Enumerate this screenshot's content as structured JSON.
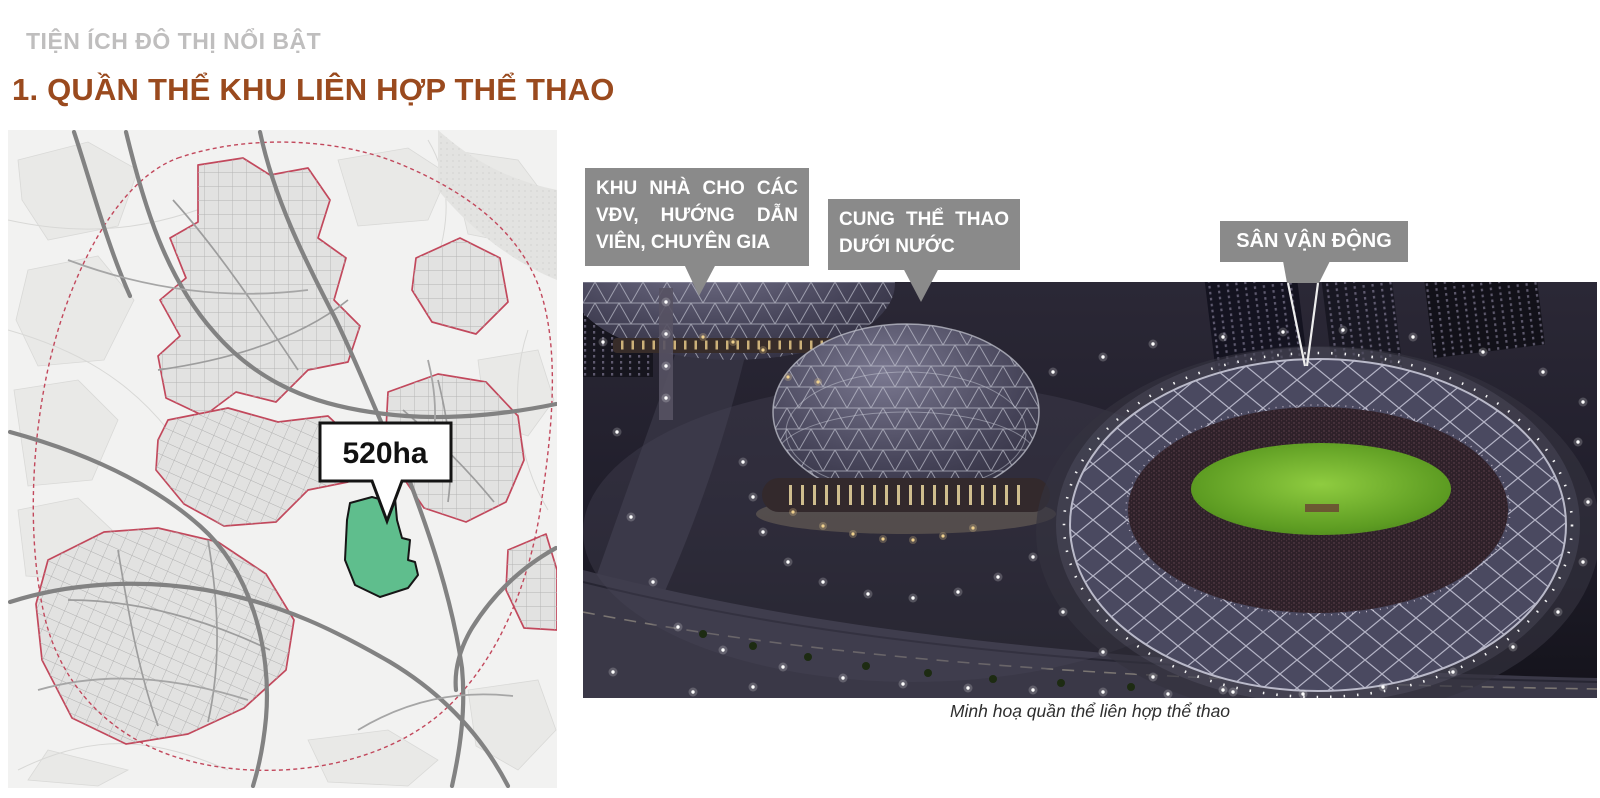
{
  "header": {
    "eyebrow": "TIỆN ÍCH ĐÔ THỊ NỔI BẬT",
    "title": "1. QUẦN THỂ KHU LIÊN HỢP THỂ THAO",
    "eyebrow_color": "#bfbebe",
    "title_color": "#9a4a1e"
  },
  "map": {
    "area_label": "520ha",
    "site_color": "#5fbe8d",
    "boundary_color": "#c2485c",
    "road_color": "#828282"
  },
  "photo": {
    "callouts": [
      {
        "id": "athletes-housing",
        "lines": [
          "KHU NHÀ CHO CÁC",
          "VĐV, HƯỚNG DẪN",
          "VIÊN, CHUYÊN GIA"
        ]
      },
      {
        "id": "aquatics-palace",
        "lines": [
          "CUNG THỂ THAO",
          "DƯỚI NƯỚC"
        ]
      },
      {
        "id": "stadium",
        "lines": [
          "SÂN VẬN ĐỘNG"
        ]
      }
    ],
    "callout_bg": "#8a8a8a",
    "caption": "Minh hoạ quần thể liên hợp thể thao",
    "field_color": "#6fb32e"
  }
}
